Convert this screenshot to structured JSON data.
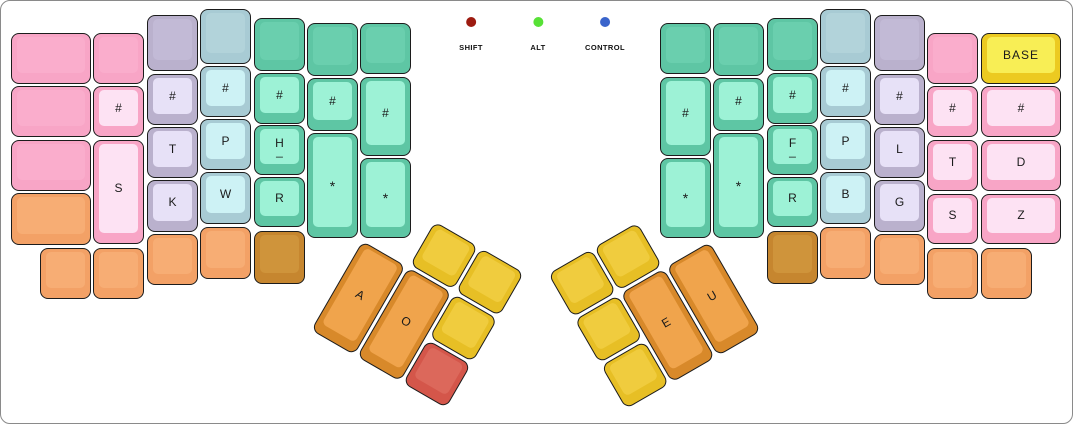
{
  "canvas": {
    "width": 1073,
    "height": 424,
    "background": "#ffffff",
    "border_color": "#8a8a8a"
  },
  "legend": {
    "items": [
      {
        "label": "SHIFT",
        "color": "#9d1b10",
        "x": 470
      },
      {
        "label": "ALT",
        "color": "#57e136",
        "x": 537
      },
      {
        "label": "CONTROL",
        "color": "#3a64cb",
        "x": 604
      }
    ]
  },
  "palette": {
    "pink": {
      "side": "#f8a5c6",
      "top": "#faadcc"
    },
    "pink_pale": {
      "side": "#f8a5c6",
      "top": "#fde2f3"
    },
    "lavender": {
      "side": "#bab1cd",
      "top": "#c2bad6"
    },
    "lavender_pale": {
      "side": "#bab1cd",
      "top": "#e7e1f7"
    },
    "blue": {
      "side": "#a8cbd4",
      "top": "#b2d3da"
    },
    "blue_pale": {
      "side": "#a8cbd4",
      "top": "#cdf2f5"
    },
    "green": {
      "side": "#5ec6a4",
      "top": "#6acfae"
    },
    "green_pale": {
      "side": "#5ec6a4",
      "top": "#9df2d6"
    },
    "orange": {
      "side": "#f3a166",
      "top": "#f7ad74"
    },
    "brown": {
      "side": "#c6862f",
      "top": "#cf943b"
    },
    "thumb_orange": {
      "side": "#d8892a",
      "top": "#f0a44c"
    },
    "yellow": {
      "side": "#e7bf25",
      "top": "#f0cc3e"
    },
    "red": {
      "side": "#d4564a",
      "top": "#dc685b"
    },
    "base_yellow": {
      "side": "#ecca21",
      "top": "#f8ee55"
    }
  },
  "main_keys": [
    {
      "id": "l1-r1-blank",
      "scheme": "pink",
      "x": 10,
      "y": 32,
      "w": 80,
      "h": 51
    },
    {
      "id": "l1-r2-blank",
      "scheme": "pink",
      "x": 10,
      "y": 85,
      "w": 80,
      "h": 51
    },
    {
      "id": "l1-r3-blank",
      "scheme": "pink",
      "x": 10,
      "y": 139,
      "w": 80,
      "h": 51
    },
    {
      "id": "l1-r4-blank",
      "scheme": "orange",
      "x": 10,
      "y": 192,
      "w": 80,
      "h": 52
    },
    {
      "id": "l1-bottom-blank",
      "scheme": "orange",
      "x": 39,
      "y": 247,
      "w": 51,
      "h": 51
    },
    {
      "id": "l2-r1-blank",
      "scheme": "pink",
      "x": 92,
      "y": 32,
      "w": 51,
      "h": 51
    },
    {
      "id": "l2-number",
      "label": "#",
      "scheme": "pink_pale",
      "x": 92,
      "y": 85,
      "w": 51,
      "h": 51
    },
    {
      "id": "l2-s",
      "label": "S",
      "scheme": "pink_pale",
      "x": 92,
      "y": 139,
      "w": 51,
      "h": 104
    },
    {
      "id": "l2-bottom-blank",
      "scheme": "orange",
      "x": 92,
      "y": 247,
      "w": 51,
      "h": 51
    },
    {
      "id": "l3-r1-blank",
      "scheme": "lavender",
      "x": 146,
      "y": 14,
      "w": 51,
      "h": 56
    },
    {
      "id": "l3-number",
      "label": "#",
      "scheme": "lavender_pale",
      "x": 146,
      "y": 73,
      "w": 51,
      "h": 51
    },
    {
      "id": "l3-t",
      "label": "T",
      "scheme": "lavender_pale",
      "x": 146,
      "y": 126,
      "w": 51,
      "h": 51
    },
    {
      "id": "l3-k",
      "label": "K",
      "scheme": "lavender_pale",
      "x": 146,
      "y": 179,
      "w": 51,
      "h": 52
    },
    {
      "id": "l3-bottom-blank",
      "scheme": "orange",
      "x": 146,
      "y": 233,
      "w": 51,
      "h": 51
    },
    {
      "id": "l4-r1-blank",
      "scheme": "blue",
      "x": 199,
      "y": 8,
      "w": 51,
      "h": 55
    },
    {
      "id": "l4-number",
      "label": "#",
      "scheme": "blue_pale",
      "x": 199,
      "y": 65,
      "w": 51,
      "h": 51
    },
    {
      "id": "l4-p",
      "label": "P",
      "scheme": "blue_pale",
      "x": 199,
      "y": 118,
      "w": 51,
      "h": 51
    },
    {
      "id": "l4-w",
      "label": "W",
      "scheme": "blue_pale",
      "x": 199,
      "y": 171,
      "w": 51,
      "h": 52
    },
    {
      "id": "l4-bottom-blank",
      "scheme": "orange",
      "x": 199,
      "y": 226,
      "w": 51,
      "h": 52
    },
    {
      "id": "l5-r1-blank",
      "scheme": "green",
      "x": 253,
      "y": 17,
      "w": 51,
      "h": 53
    },
    {
      "id": "l5-number",
      "label": "#",
      "scheme": "green_pale",
      "x": 253,
      "y": 72,
      "w": 51,
      "h": 51
    },
    {
      "id": "l5-h",
      "label": "H",
      "sub": "_",
      "scheme": "green_pale",
      "x": 253,
      "y": 124,
      "w": 51,
      "h": 50
    },
    {
      "id": "l5-r",
      "label": "R",
      "scheme": "green_pale",
      "x": 253,
      "y": 176,
      "w": 51,
      "h": 50
    },
    {
      "id": "l5-bottom-blank",
      "scheme": "brown",
      "x": 253,
      "y": 230,
      "w": 51,
      "h": 53
    },
    {
      "id": "l6-r1-blank",
      "scheme": "green",
      "x": 306,
      "y": 22,
      "w": 51,
      "h": 53
    },
    {
      "id": "l6-number",
      "label": "#",
      "scheme": "green_pale",
      "x": 306,
      "y": 77,
      "w": 51,
      "h": 53
    },
    {
      "id": "l6-star",
      "label": "*",
      "scheme": "green_pale",
      "x": 306,
      "y": 132,
      "w": 51,
      "h": 105
    },
    {
      "id": "l7-r1-blank",
      "scheme": "green",
      "x": 359,
      "y": 22,
      "w": 51,
      "h": 51
    },
    {
      "id": "l7-number",
      "label": "#",
      "scheme": "green_pale",
      "x": 359,
      "y": 76,
      "w": 51,
      "h": 79
    },
    {
      "id": "l7-star",
      "label": "*",
      "scheme": "green_pale",
      "x": 359,
      "y": 157,
      "w": 51,
      "h": 80
    },
    {
      "id": "r1-r1-blank",
      "scheme": "green",
      "x": 659,
      "y": 22,
      "w": 51,
      "h": 51
    },
    {
      "id": "r1-number",
      "label": "#",
      "scheme": "green_pale",
      "x": 659,
      "y": 76,
      "w": 51,
      "h": 79
    },
    {
      "id": "r1-star",
      "label": "*",
      "scheme": "green_pale",
      "x": 659,
      "y": 157,
      "w": 51,
      "h": 80
    },
    {
      "id": "r2-r1-blank",
      "scheme": "green",
      "x": 712,
      "y": 22,
      "w": 51,
      "h": 53
    },
    {
      "id": "r2-number",
      "label": "#",
      "scheme": "green_pale",
      "x": 712,
      "y": 77,
      "w": 51,
      "h": 53
    },
    {
      "id": "r2-star",
      "label": "*",
      "scheme": "green_pale",
      "x": 712,
      "y": 132,
      "w": 51,
      "h": 105
    },
    {
      "id": "r3-r1-blank",
      "scheme": "green",
      "x": 766,
      "y": 17,
      "w": 51,
      "h": 53
    },
    {
      "id": "r3-number",
      "label": "#",
      "scheme": "green_pale",
      "x": 766,
      "y": 72,
      "w": 51,
      "h": 51
    },
    {
      "id": "r3-f",
      "label": "F",
      "sub": "_",
      "scheme": "green_pale",
      "x": 766,
      "y": 124,
      "w": 51,
      "h": 50
    },
    {
      "id": "r3-r",
      "label": "R",
      "scheme": "green_pale",
      "x": 766,
      "y": 176,
      "w": 51,
      "h": 50
    },
    {
      "id": "r3-bottom-blank",
      "scheme": "brown",
      "x": 766,
      "y": 230,
      "w": 51,
      "h": 53
    },
    {
      "id": "r4-r1-blank",
      "scheme": "blue",
      "x": 819,
      "y": 8,
      "w": 51,
      "h": 55
    },
    {
      "id": "r4-number",
      "label": "#",
      "scheme": "blue_pale",
      "x": 819,
      "y": 65,
      "w": 51,
      "h": 51
    },
    {
      "id": "r4-p",
      "label": "P",
      "scheme": "blue_pale",
      "x": 819,
      "y": 118,
      "w": 51,
      "h": 51
    },
    {
      "id": "r4-b",
      "label": "B",
      "scheme": "blue_pale",
      "x": 819,
      "y": 171,
      "w": 51,
      "h": 52
    },
    {
      "id": "r4-bottom-blank",
      "scheme": "orange",
      "x": 819,
      "y": 226,
      "w": 51,
      "h": 52
    },
    {
      "id": "r5-r1-blank",
      "scheme": "lavender",
      "x": 873,
      "y": 14,
      "w": 51,
      "h": 56
    },
    {
      "id": "r5-number",
      "label": "#",
      "scheme": "lavender_pale",
      "x": 873,
      "y": 73,
      "w": 51,
      "h": 51
    },
    {
      "id": "r5-l",
      "label": "L",
      "scheme": "lavender_pale",
      "x": 873,
      "y": 126,
      "w": 51,
      "h": 51
    },
    {
      "id": "r5-g",
      "label": "G",
      "scheme": "lavender_pale",
      "x": 873,
      "y": 179,
      "w": 51,
      "h": 52
    },
    {
      "id": "r5-bottom-blank",
      "scheme": "orange",
      "x": 873,
      "y": 233,
      "w": 51,
      "h": 51
    },
    {
      "id": "r6-r1-blank",
      "scheme": "pink",
      "x": 926,
      "y": 32,
      "w": 51,
      "h": 51
    },
    {
      "id": "r6-number",
      "label": "#",
      "scheme": "pink_pale",
      "x": 926,
      "y": 85,
      "w": 51,
      "h": 51
    },
    {
      "id": "r6-t",
      "label": "T",
      "scheme": "pink_pale",
      "x": 926,
      "y": 139,
      "w": 51,
      "h": 51
    },
    {
      "id": "r6-s",
      "label": "S",
      "scheme": "pink_pale",
      "x": 926,
      "y": 193,
      "w": 51,
      "h": 50
    },
    {
      "id": "r6-bottom-blank",
      "scheme": "orange",
      "x": 926,
      "y": 247,
      "w": 51,
      "h": 51
    },
    {
      "id": "r7-base",
      "label": "BASE",
      "scheme": "base_yellow",
      "x": 980,
      "y": 32,
      "w": 80,
      "h": 51
    },
    {
      "id": "r7-number",
      "label": "#",
      "scheme": "pink_pale",
      "x": 980,
      "y": 85,
      "w": 80,
      "h": 51
    },
    {
      "id": "r7-d",
      "label": "D",
      "scheme": "pink_pale",
      "x": 980,
      "y": 139,
      "w": 80,
      "h": 51
    },
    {
      "id": "r7-z",
      "label": "Z",
      "scheme": "pink_pale",
      "x": 980,
      "y": 193,
      "w": 80,
      "h": 50
    },
    {
      "id": "r7-bottom-blank",
      "scheme": "orange",
      "x": 980,
      "y": 247,
      "w": 51,
      "h": 51
    }
  ],
  "thumb_clusters": [
    {
      "id": "left-thumb-cluster",
      "x": 388,
      "y": 194,
      "rotation": 30,
      "keys": [
        {
          "id": "thumb-a",
          "label": "A",
          "scheme": "thumb_orange",
          "x": 0,
          "y": 53,
          "w": 50,
          "h": 103
        },
        {
          "id": "thumb-o",
          "label": "O",
          "scheme": "thumb_orange",
          "x": 53,
          "y": 53,
          "w": 50,
          "h": 103
        },
        {
          "id": "left-thumb-yellow-1",
          "scheme": "yellow",
          "x": 53,
          "y": 0,
          "w": 50,
          "h": 50
        },
        {
          "id": "left-thumb-yellow-2",
          "scheme": "yellow",
          "x": 106,
          "y": 0,
          "w": 50,
          "h": 50
        },
        {
          "id": "left-thumb-yellow-3",
          "scheme": "yellow",
          "x": 106,
          "y": 53,
          "w": 50,
          "h": 50
        },
        {
          "id": "left-thumb-red",
          "scheme": "red",
          "x": 106,
          "y": 106,
          "w": 50,
          "h": 50
        }
      ]
    },
    {
      "id": "right-thumb-cluster",
      "x": 547,
      "y": 273,
      "rotation": -30,
      "keys": [
        {
          "id": "right-thumb-yellow-1",
          "scheme": "yellow",
          "x": 0,
          "y": 0,
          "w": 50,
          "h": 50
        },
        {
          "id": "right-thumb-yellow-2",
          "scheme": "yellow",
          "x": 0,
          "y": 53,
          "w": 50,
          "h": 50
        },
        {
          "id": "right-thumb-yellow-3",
          "scheme": "yellow",
          "x": 0,
          "y": 106,
          "w": 50,
          "h": 50
        },
        {
          "id": "right-thumb-yellow-4",
          "scheme": "yellow",
          "x": 53,
          "y": 0,
          "w": 50,
          "h": 50
        },
        {
          "id": "thumb-e",
          "label": "E",
          "scheme": "thumb_orange",
          "x": 53,
          "y": 53,
          "w": 50,
          "h": 103
        },
        {
          "id": "thumb-u",
          "label": "U",
          "scheme": "thumb_orange",
          "x": 106,
          "y": 53,
          "w": 50,
          "h": 103
        }
      ]
    }
  ]
}
